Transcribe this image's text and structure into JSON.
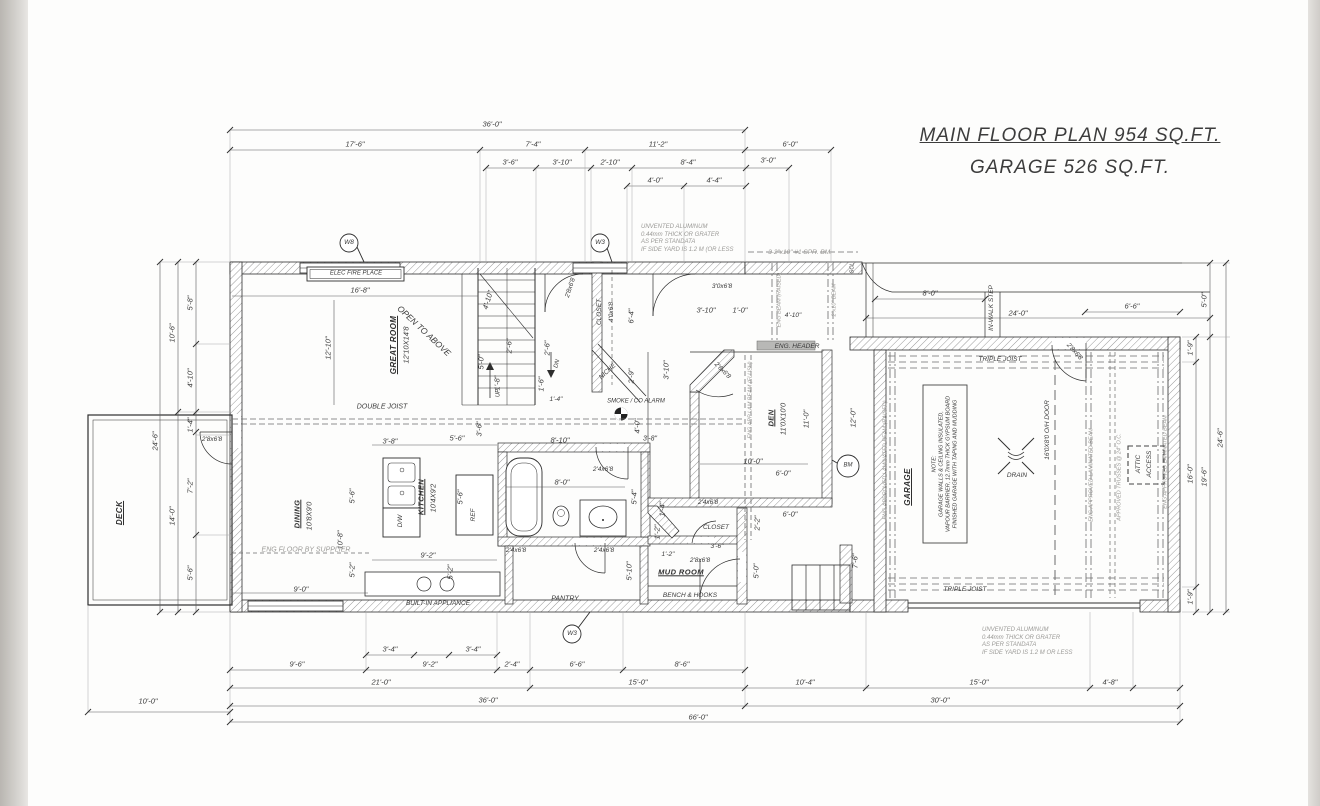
{
  "title": {
    "line1": "MAIN FLOOR PLAN 954 SQ.FT.",
    "line2": "GARAGE 526 SQ.FT."
  },
  "colors": {
    "ink": "#2e2e2e",
    "dim": "#5a5a5a",
    "gray_note": "#9b9a97",
    "hatch": "#9a9a9a"
  },
  "notes": {
    "top_siding": "UNVENTED ALUMINUM\n0.44mm THICK OR GRATER\nAS PER STANDATA\nIF SIDE YARD IS 1.2 M (OR LESS",
    "bottom_siding": "UNVENTED ALUMINUM\n0.44mm THICK OR GRATER\nAS PER STANDATA\nIF SIDE YARD IS 1.2 M OR LESS",
    "garage_note": "NOTE:\nGARAGE WALLS & CEILING INSULATED,\nVAPOUR BARRIER, 12.7mm THICK GYPSUM BOARD\nFINISHED GARAGE WITH TAPING AND MUDDING"
  },
  "labels": [
    {
      "t": "36'-0\"",
      "x": 492,
      "y": 124
    },
    {
      "t": "17'-6\"",
      "x": 355,
      "y": 144
    },
    {
      "t": "7'-4\"",
      "x": 533,
      "y": 144
    },
    {
      "t": "11'-2\"",
      "x": 658,
      "y": 144
    },
    {
      "t": "6'-0\"",
      "x": 790,
      "y": 144
    },
    {
      "t": "3'-6\"",
      "x": 510,
      "y": 162
    },
    {
      "t": "3'-10\"",
      "x": 562,
      "y": 162
    },
    {
      "t": "2'-10\"",
      "x": 610,
      "y": 162
    },
    {
      "t": "8'-4\"",
      "x": 688,
      "y": 162
    },
    {
      "t": "3'-0\"",
      "x": 768,
      "y": 160
    },
    {
      "t": "4'-0\"",
      "x": 655,
      "y": 180
    },
    {
      "t": "4'-4\"",
      "x": 714,
      "y": 180
    },
    {
      "t": "3'-4\"",
      "x": 390,
      "y": 649
    },
    {
      "t": "3'-4\"",
      "x": 473,
      "y": 649
    },
    {
      "t": "9'-6\"",
      "x": 297,
      "y": 664
    },
    {
      "t": "9'-2\"",
      "x": 430,
      "y": 664
    },
    {
      "t": "2'-4\"",
      "x": 512,
      "y": 664
    },
    {
      "t": "6'-6\"",
      "x": 577,
      "y": 664
    },
    {
      "t": "8'-6\"",
      "x": 682,
      "y": 664
    },
    {
      "t": "21'-0\"",
      "x": 381,
      "y": 682
    },
    {
      "t": "15'-0\"",
      "x": 638,
      "y": 682
    },
    {
      "t": "10'-4\"",
      "x": 805,
      "y": 682
    },
    {
      "t": "15'-0\"",
      "x": 979,
      "y": 682
    },
    {
      "t": "4'-8\"",
      "x": 1110,
      "y": 682
    },
    {
      "t": "36'-0\"",
      "x": 488,
      "y": 700
    },
    {
      "t": "30'-0\"",
      "x": 940,
      "y": 700
    },
    {
      "t": "66'-0\"",
      "x": 698,
      "y": 717
    },
    {
      "t": "10'-0\"",
      "x": 148,
      "y": 701
    },
    {
      "t": "5'-8\"",
      "x": 190,
      "y": 303,
      "r": -90
    },
    {
      "t": "10'-6\"",
      "x": 172,
      "y": 333,
      "r": -90
    },
    {
      "t": "4'-10\"",
      "x": 190,
      "y": 378,
      "r": -90
    },
    {
      "t": "24'-6\"",
      "x": 155,
      "y": 441,
      "r": -90
    },
    {
      "t": "1'-4\"",
      "x": 190,
      "y": 425,
      "r": -90
    },
    {
      "t": "7'-2\"",
      "x": 190,
      "y": 486,
      "r": -90
    },
    {
      "t": "14'-0\"",
      "x": 172,
      "y": 516,
      "r": -90
    },
    {
      "t": "5'-6\"",
      "x": 190,
      "y": 573,
      "r": -90
    },
    {
      "t": "5'-0\"",
      "x": 1204,
      "y": 300,
      "r": -90
    },
    {
      "t": "1'-9\"",
      "x": 1190,
      "y": 348,
      "r": -90
    },
    {
      "t": "16'-0\"",
      "x": 1190,
      "y": 474,
      "r": -90
    },
    {
      "t": "19'-6\"",
      "x": 1204,
      "y": 477,
      "r": -90
    },
    {
      "t": "24'-6\"",
      "x": 1220,
      "y": 438,
      "r": -90
    },
    {
      "t": "1'-9\"",
      "x": 1190,
      "y": 597,
      "r": -90
    },
    {
      "t": "8'-0\"",
      "x": 930,
      "y": 293
    },
    {
      "t": "IN-WALK STEP",
      "x": 992,
      "y": 308,
      "r": -90,
      "s": 6.5
    },
    {
      "t": "24'-0\"",
      "x": 1018,
      "y": 313
    },
    {
      "t": "6'-6\"",
      "x": 1132,
      "y": 306
    },
    {
      "t": "16'-8\"",
      "x": 360,
      "y": 290
    },
    {
      "t": "12'-10\"",
      "x": 328,
      "y": 348,
      "r": -90
    },
    {
      "t": "GREAT ROOM",
      "x": 394,
      "y": 345,
      "r": -90,
      "k": "room",
      "s": 8
    },
    {
      "t": "12'10X14'8",
      "x": 406,
      "y": 345,
      "r": -90
    },
    {
      "t": "OPEN TO ABOVE",
      "x": 424,
      "y": 331,
      "r": 43,
      "s": 8.5
    },
    {
      "t": "DOUBLE JOIST",
      "x": 382,
      "y": 408,
      "s": 7
    },
    {
      "t": "4'-10\"",
      "x": 488,
      "y": 300,
      "r": -73
    },
    {
      "t": "5'-0\"",
      "x": 481,
      "y": 362,
      "r": -90
    },
    {
      "t": "1'-8\"",
      "x": 497,
      "y": 383,
      "r": -90
    },
    {
      "t": "2'-6\"",
      "x": 509,
      "y": 346,
      "r": -90
    },
    {
      "t": "UP",
      "x": 499,
      "y": 393,
      "r": -90,
      "s": 6
    },
    {
      "t": "DN",
      "x": 558,
      "y": 364,
      "r": -75,
      "s": 6
    },
    {
      "t": "1'-6\"",
      "x": 541,
      "y": 384,
      "r": -90
    },
    {
      "t": "2'-6\"",
      "x": 547,
      "y": 348,
      "r": -90
    },
    {
      "t": "1'-4\"",
      "x": 556,
      "y": 400,
      "s": 6.5
    },
    {
      "t": "2'8x6'8",
      "x": 571,
      "y": 288,
      "r": -72,
      "s": 6.5
    },
    {
      "t": "CLOSET",
      "x": 600,
      "y": 312,
      "r": -90,
      "s": 6.5
    },
    {
      "t": "4'0x6'8",
      "x": 612,
      "y": 312,
      "r": -90,
      "s": 6.5
    },
    {
      "t": "6'-4\"",
      "x": 631,
      "y": 316,
      "r": -90
    },
    {
      "t": "3'0x6'8",
      "x": 722,
      "y": 287,
      "s": 6.5
    },
    {
      "t": "3'-10\"",
      "x": 706,
      "y": 310
    },
    {
      "t": "1'-0\"",
      "x": 740,
      "y": 310
    },
    {
      "t": "NICHE",
      "x": 608,
      "y": 372,
      "r": -43,
      "s": 6.5
    },
    {
      "t": "2'-9\"",
      "x": 631,
      "y": 376,
      "r": -90
    },
    {
      "t": "3'-10\"",
      "x": 666,
      "y": 370,
      "r": -90
    },
    {
      "t": "SMOKE / CO ALARM",
      "x": 636,
      "y": 402,
      "s": 6
    },
    {
      "t": "4'-0\"",
      "x": 637,
      "y": 426,
      "r": -90
    },
    {
      "t": "8'-10\"",
      "x": 560,
      "y": 440
    },
    {
      "t": "3'-8\"",
      "x": 650,
      "y": 440,
      "s": 7
    },
    {
      "t": "2'4x6'8",
      "x": 603,
      "y": 470,
      "s": 6.5
    },
    {
      "t": "8'-0\"",
      "x": 562,
      "y": 482
    },
    {
      "t": "5'-4\"",
      "x": 634,
      "y": 497,
      "r": -90
    },
    {
      "t": "2'4x6'8",
      "x": 516,
      "y": 551,
      "s": 6.5
    },
    {
      "t": "2'4x6'8",
      "x": 604,
      "y": 551,
      "s": 6.5
    },
    {
      "t": "5'-10\"",
      "x": 629,
      "y": 571,
      "r": -90
    },
    {
      "t": "1'-2\"",
      "x": 657,
      "y": 532,
      "r": -90
    },
    {
      "t": "1'-4\"",
      "x": 662,
      "y": 509,
      "r": -90
    },
    {
      "t": "3'-8\"",
      "x": 390,
      "y": 441
    },
    {
      "t": "5'-6\"",
      "x": 457,
      "y": 438
    },
    {
      "t": "3'-6\"",
      "x": 479,
      "y": 429,
      "r": -90
    },
    {
      "t": "5'-6\"",
      "x": 352,
      "y": 496,
      "r": -90
    },
    {
      "t": "5'-6\"",
      "x": 460,
      "y": 497,
      "r": -90
    },
    {
      "t": "10'-8\"",
      "x": 340,
      "y": 540,
      "r": -90
    },
    {
      "t": "KITCHEN",
      "x": 421,
      "y": 497,
      "r": -90,
      "k": "room",
      "s": 7.5
    },
    {
      "t": "10'4X9'2",
      "x": 433,
      "y": 498,
      "r": -90
    },
    {
      "t": "DINING",
      "x": 297,
      "y": 514,
      "r": -90,
      "k": "room",
      "s": 7.5
    },
    {
      "t": "10'8X9'0",
      "x": 309,
      "y": 516,
      "r": -90
    },
    {
      "t": "REF",
      "x": 474,
      "y": 515,
      "r": -90,
      "s": 6.5
    },
    {
      "t": "D/W",
      "x": 401,
      "y": 521,
      "r": -90,
      "s": 6.5
    },
    {
      "t": "ENG FLOOR BY SUPPLIER",
      "x": 306,
      "y": 551,
      "s": 7,
      "k": "gray"
    },
    {
      "t": "5'-2\"",
      "x": 352,
      "y": 570,
      "r": -90
    },
    {
      "t": "5'-2\"",
      "x": 450,
      "y": 572,
      "r": -90
    },
    {
      "t": "9'-2\"",
      "x": 428,
      "y": 555
    },
    {
      "t": "9'-0\"",
      "x": 301,
      "y": 589
    },
    {
      "t": "BUILT-IN APPLIANCE",
      "x": 438,
      "y": 604,
      "s": 6.5
    },
    {
      "t": "PANTRY",
      "x": 565,
      "y": 600,
      "s": 7
    },
    {
      "t": "ENG. HEADER",
      "x": 797,
      "y": 347,
      "s": 6.5
    },
    {
      "t": "DEN",
      "x": 771,
      "y": 418,
      "r": -90,
      "k": "room",
      "s": 7.5
    },
    {
      "t": "11'0X10'0",
      "x": 783,
      "y": 419,
      "r": -90
    },
    {
      "t": "11'-0\"",
      "x": 806,
      "y": 419,
      "r": -90
    },
    {
      "t": "12'-0\"",
      "x": 853,
      "y": 418,
      "r": -90
    },
    {
      "t": "10'-0\"",
      "x": 753,
      "y": 461
    },
    {
      "t": "6'-0\"",
      "x": 783,
      "y": 473
    },
    {
      "t": "6'-0\"",
      "x": 790,
      "y": 514
    },
    {
      "t": "2'-2\"",
      "x": 757,
      "y": 523,
      "r": -90
    },
    {
      "t": "2'6x6'8",
      "x": 722,
      "y": 371,
      "r": 45,
      "s": 6.5
    },
    {
      "t": "ENG APP LAM BEAM (FLUSH)",
      "x": 751,
      "y": 400,
      "r": -90,
      "s": 5.5,
      "k": "gray"
    },
    {
      "t": "ENG BEAM (RAISED)",
      "x": 780,
      "y": 300,
      "r": -90,
      "s": 5.5,
      "k": "gray"
    },
    {
      "t": "2\"x10\" BEAM",
      "x": 835,
      "y": 300,
      "r": -90,
      "s": 5.5,
      "k": "gray"
    },
    {
      "t": "3-2\"x10\" #1 SPR. BM.",
      "x": 800,
      "y": 253,
      "s": 6.5,
      "k": "gray"
    },
    {
      "t": "SCL",
      "x": 853,
      "y": 268,
      "r": -90,
      "s": 5.5
    },
    {
      "t": "4'-10\"",
      "x": 793,
      "y": 316,
      "s": 6.5
    },
    {
      "t": "7'-6\"",
      "x": 855,
      "y": 561,
      "r": -90
    },
    {
      "t": "5'-0\"",
      "x": 756,
      "y": 571,
      "r": -90
    },
    {
      "t": "BM",
      "x": 848,
      "y": 466,
      "s": 6
    },
    {
      "t": "CLOSET",
      "x": 716,
      "y": 528,
      "s": 6.5
    },
    {
      "t": "2'4x6'8",
      "x": 708,
      "y": 503,
      "s": 6.5
    },
    {
      "t": "3'-6\"",
      "x": 717,
      "y": 547,
      "s": 6.5
    },
    {
      "t": "1'-2\"",
      "x": 668,
      "y": 555,
      "s": 6.5
    },
    {
      "t": "2'8x6'8",
      "x": 700,
      "y": 561,
      "s": 6.5
    },
    {
      "t": "MUD ROOM",
      "x": 681,
      "y": 572,
      "k": "room",
      "s": 7.5
    },
    {
      "t": "BENCH & HOOKS",
      "x": 690,
      "y": 596,
      "s": 6.5
    },
    {
      "t": "DECK",
      "x": 120,
      "y": 513,
      "r": -90,
      "k": "room",
      "s": 8
    },
    {
      "t": "2'8x6'8",
      "x": 212,
      "y": 440,
      "s": 6.5
    },
    {
      "t": "TRIPLE JOIST",
      "x": 1000,
      "y": 360,
      "s": 6.5
    },
    {
      "t": "TRIPLE JOIST",
      "x": 965,
      "y": 590,
      "s": 6.5
    },
    {
      "t": "GARAGE",
      "x": 908,
      "y": 487,
      "r": -90,
      "k": "room",
      "s": 8
    },
    {
      "t": "16'0X8'0 O/H DOOR",
      "x": 1048,
      "y": 430,
      "r": -90,
      "s": 6.5
    },
    {
      "t": "DRAIN",
      "x": 1017,
      "y": 476,
      "s": 6.5
    },
    {
      "t": "ATTIC",
      "x": 1139,
      "y": 464,
      "r": -90,
      "s": 6.5
    },
    {
      "t": "ACCESS",
      "x": 1150,
      "y": 464,
      "r": -90,
      "s": 6.5
    },
    {
      "t": "ENG APPROVED LAMINATED BEAM (RAISED)",
      "x": 886,
      "y": 460,
      "r": -90,
      "s": 5.5,
      "k": "gray"
    },
    {
      "t": "ENG APPROVED LAMINATED BEAM",
      "x": 1092,
      "y": 475,
      "r": -90,
      "s": 5.5,
      "k": "gray"
    },
    {
      "t": "APPROVED TRUSSES @ 24\" O.C.",
      "x": 1120,
      "y": 477,
      "r": -90,
      "s": 5.5,
      "k": "gray"
    },
    {
      "t": "ENG APPROVED LAMINATED BEAM",
      "x": 1166,
      "y": 462,
      "r": -90,
      "s": 5.5,
      "k": "gray"
    },
    {
      "t": "2'8x6'8",
      "x": 1074,
      "y": 352,
      "r": 48,
      "s": 6.5
    },
    {
      "t": "W8",
      "x": 349,
      "y": 243,
      "s": 6.5
    },
    {
      "t": "W3",
      "x": 600,
      "y": 243,
      "s": 6.5
    },
    {
      "t": "W3",
      "x": 572,
      "y": 634,
      "s": 6.5
    },
    {
      "t": "ELEC FIRE PLACE",
      "x": 356,
      "y": 274,
      "s": 6
    },
    {
      "t": "NOTE:\nGARAGE WALLS & CEILING INSULATED,\nVAPOUR BARRIER, 12.7mm THICK GYPSUM BOARD\nFINISHED GARAGE WITH TAPING AND MUDDING",
      "x": 945,
      "y": 464,
      "r": -90,
      "s": 5.5
    },
    {
      "t": "UNVENTED ALUMINUM\n0.44mm THICK OR GRATER\nAS PER STANDATA\nIF SIDE YARD IS 1.2 M (OR LESS",
      "x": 641,
      "y": 224,
      "s": 6,
      "k": "gray",
      "a": "l"
    },
    {
      "t": "UNVENTED ALUMINUM\n0.44mm THICK OR GRATER\nAS PER STANDATA\nIF SIDE YARD IS 1.2 M OR LESS",
      "x": 982,
      "y": 627,
      "s": 6,
      "k": "gray",
      "a": "l"
    }
  ]
}
